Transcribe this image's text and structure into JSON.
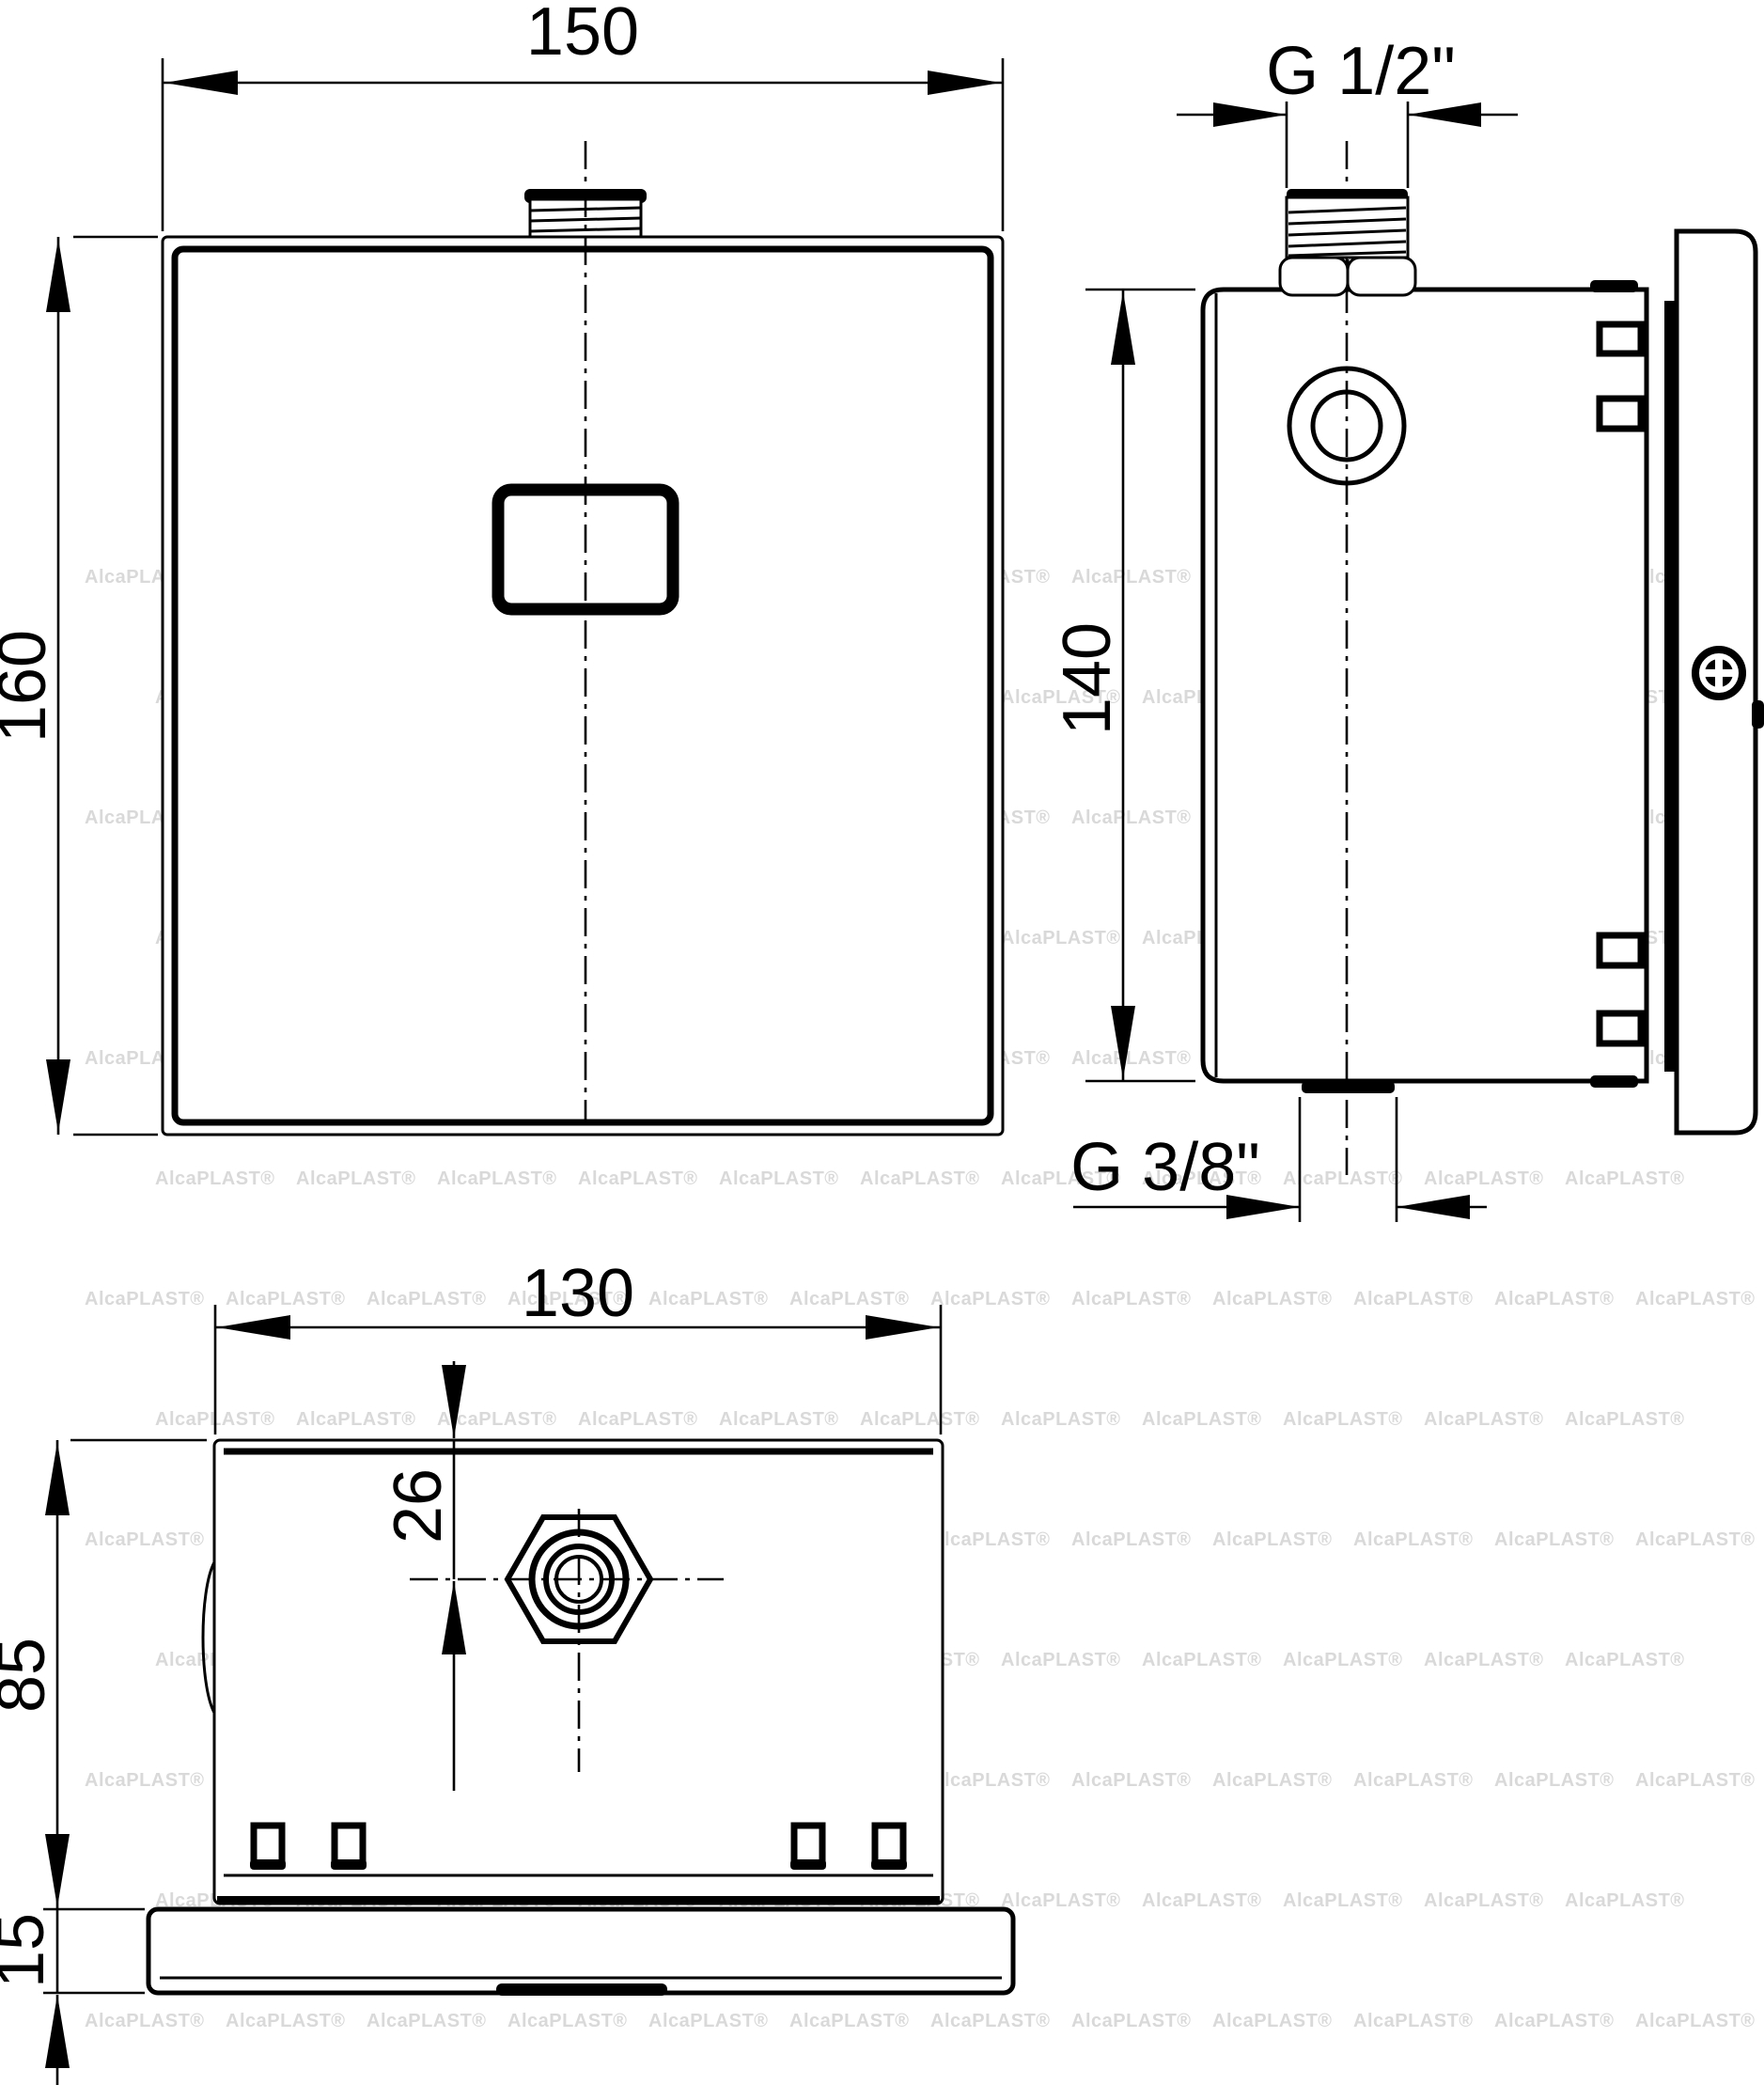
{
  "drawing_type": "technical-dimension-drawing",
  "labels": {
    "front_width": "150",
    "front_height": "160",
    "side_top_thread": "G 1/2\"",
    "side_height": "140",
    "side_bottom_thread": "G 3/8\"",
    "bottom_width": "130",
    "bottom_offset": "26",
    "bottom_depth": "85",
    "bottom_plate": "15"
  },
  "watermark": {
    "text": "AlcaPLAST®"
  },
  "colors": {
    "line": "#000000",
    "background": "#ffffff",
    "watermark": "#d9d9d9"
  }
}
